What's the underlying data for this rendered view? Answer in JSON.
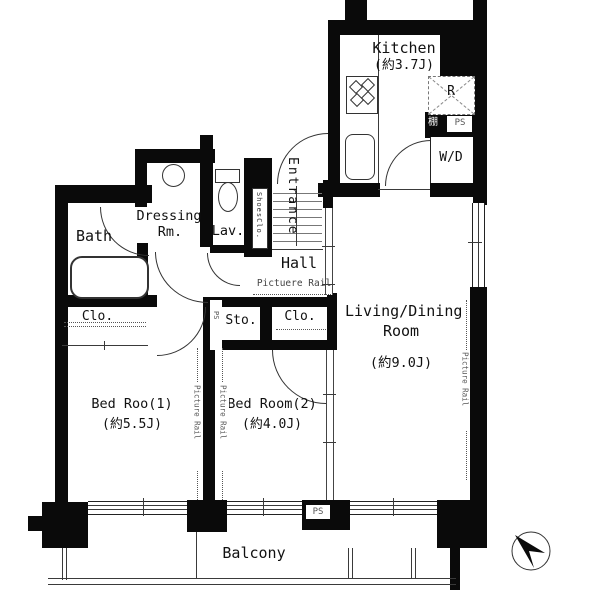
{
  "plan": {
    "rooms": {
      "kitchen": {
        "name": "Kitchen",
        "size": "(約3.7J)"
      },
      "living": {
        "name": "Living/Dining",
        "name2": "Room",
        "size": "(約9.0J)"
      },
      "bed1": {
        "name": "Bed Roo(1)",
        "size": "(約5.5J)"
      },
      "bed2": {
        "name": "Bed Room(2)",
        "size": "(約4.0J)"
      },
      "bath": {
        "name": "Bath"
      },
      "dressing": {
        "name": "Dressing",
        "name2": "Rm."
      },
      "lav": {
        "name": "Lav."
      },
      "entrance": {
        "name": "Entrance"
      },
      "hall": {
        "name": "Hall"
      },
      "balcony": {
        "name": "Balcony"
      }
    },
    "features": {
      "shoes_closet": "ShoesClo.",
      "closet_left": "Clo.",
      "closet_right": "Clo.",
      "storage": "Sto.",
      "washer_dryer": "W/D",
      "refrigerator": "R",
      "shelf": "棚",
      "ps_top": "PS",
      "ps_mid": "PS",
      "ps_bottom": "PS",
      "picture_rail_hall": "Pictuere Rail",
      "picture_rail_living": "Picture Rail",
      "picture_rail_bed1": "Picture Rail",
      "picture_rail_bed2": "Picture Rail"
    },
    "colors": {
      "wall": "#0a0a0a",
      "line": "#3a3a3a",
      "text": "#111111"
    }
  }
}
